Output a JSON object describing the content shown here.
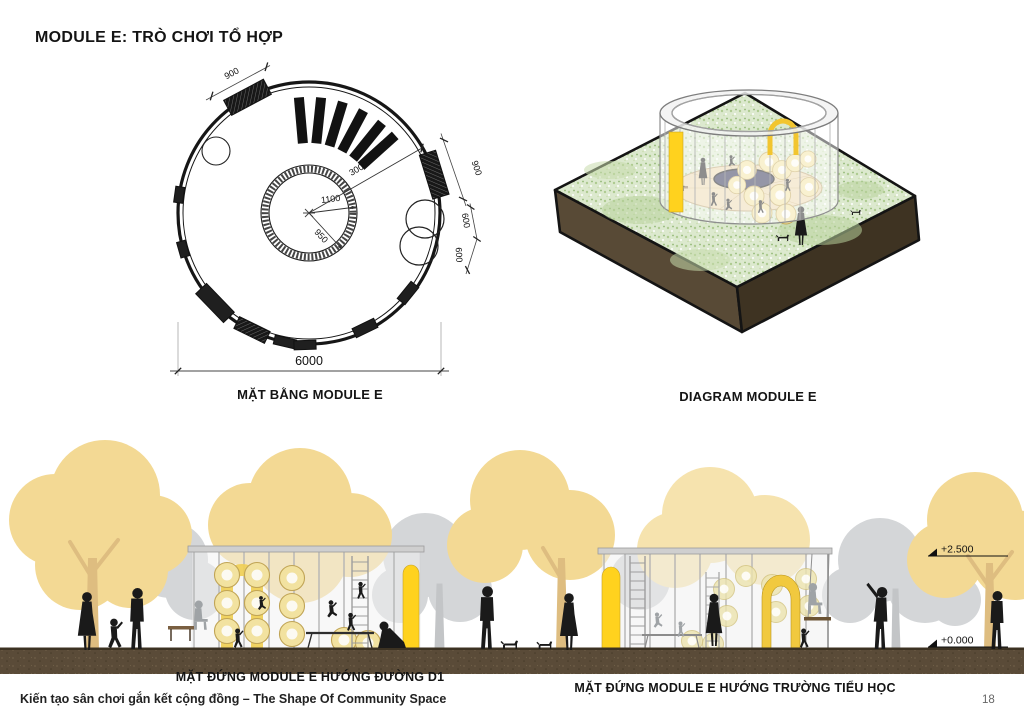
{
  "page": {
    "title": "MODULE E: TRÒ CHƠI TỔ HỢP",
    "footer": "Kiến tạo sân chơi gắn kết cộng đồng – The Shape Of Community Space",
    "page_number": "18"
  },
  "plan": {
    "caption": "MẶT BẰNG MODULE E",
    "dims": {
      "door_top": "900",
      "door_right": "900",
      "radius_outer": "3000",
      "radius_inner_a": "1100",
      "radius_inner_b": "950",
      "porthole_a": "600",
      "porthole_b": "600",
      "overall": "6000"
    }
  },
  "diagram": {
    "caption": "DIAGRAM MODULE E"
  },
  "elevations": {
    "left_caption": "MẶT ĐỨNG MODULE E HƯỚNG ĐƯỜNG D1",
    "right_caption": "MẶT ĐỨNG MODULE E HƯỚNG TRƯỜNG TIỂU HỌC",
    "level_upper": "+2.500",
    "level_lower": "+0.000"
  },
  "colors": {
    "accent_yellow": "#FFD21E",
    "arch_yellow": "#F1C93F",
    "ring_yellow": "#F2E2A0",
    "tree_yellow": "#F3D994",
    "tree_yellow_pale": "#F6E3AE",
    "tree_gray": "#D4D6D8",
    "trunk_tan": "#DEBD80",
    "trunk_gray": "#C3C5C7",
    "ground_brown": "#5A4B38",
    "base_brown": "#4E4130",
    "base_brown_dark": "#3A2F1F",
    "grass_green": "#DCE9CE",
    "pit_navy": "#2A2D4E",
    "silhouette": "#1A1A1A",
    "gray_figure": "#9FA3A6"
  }
}
